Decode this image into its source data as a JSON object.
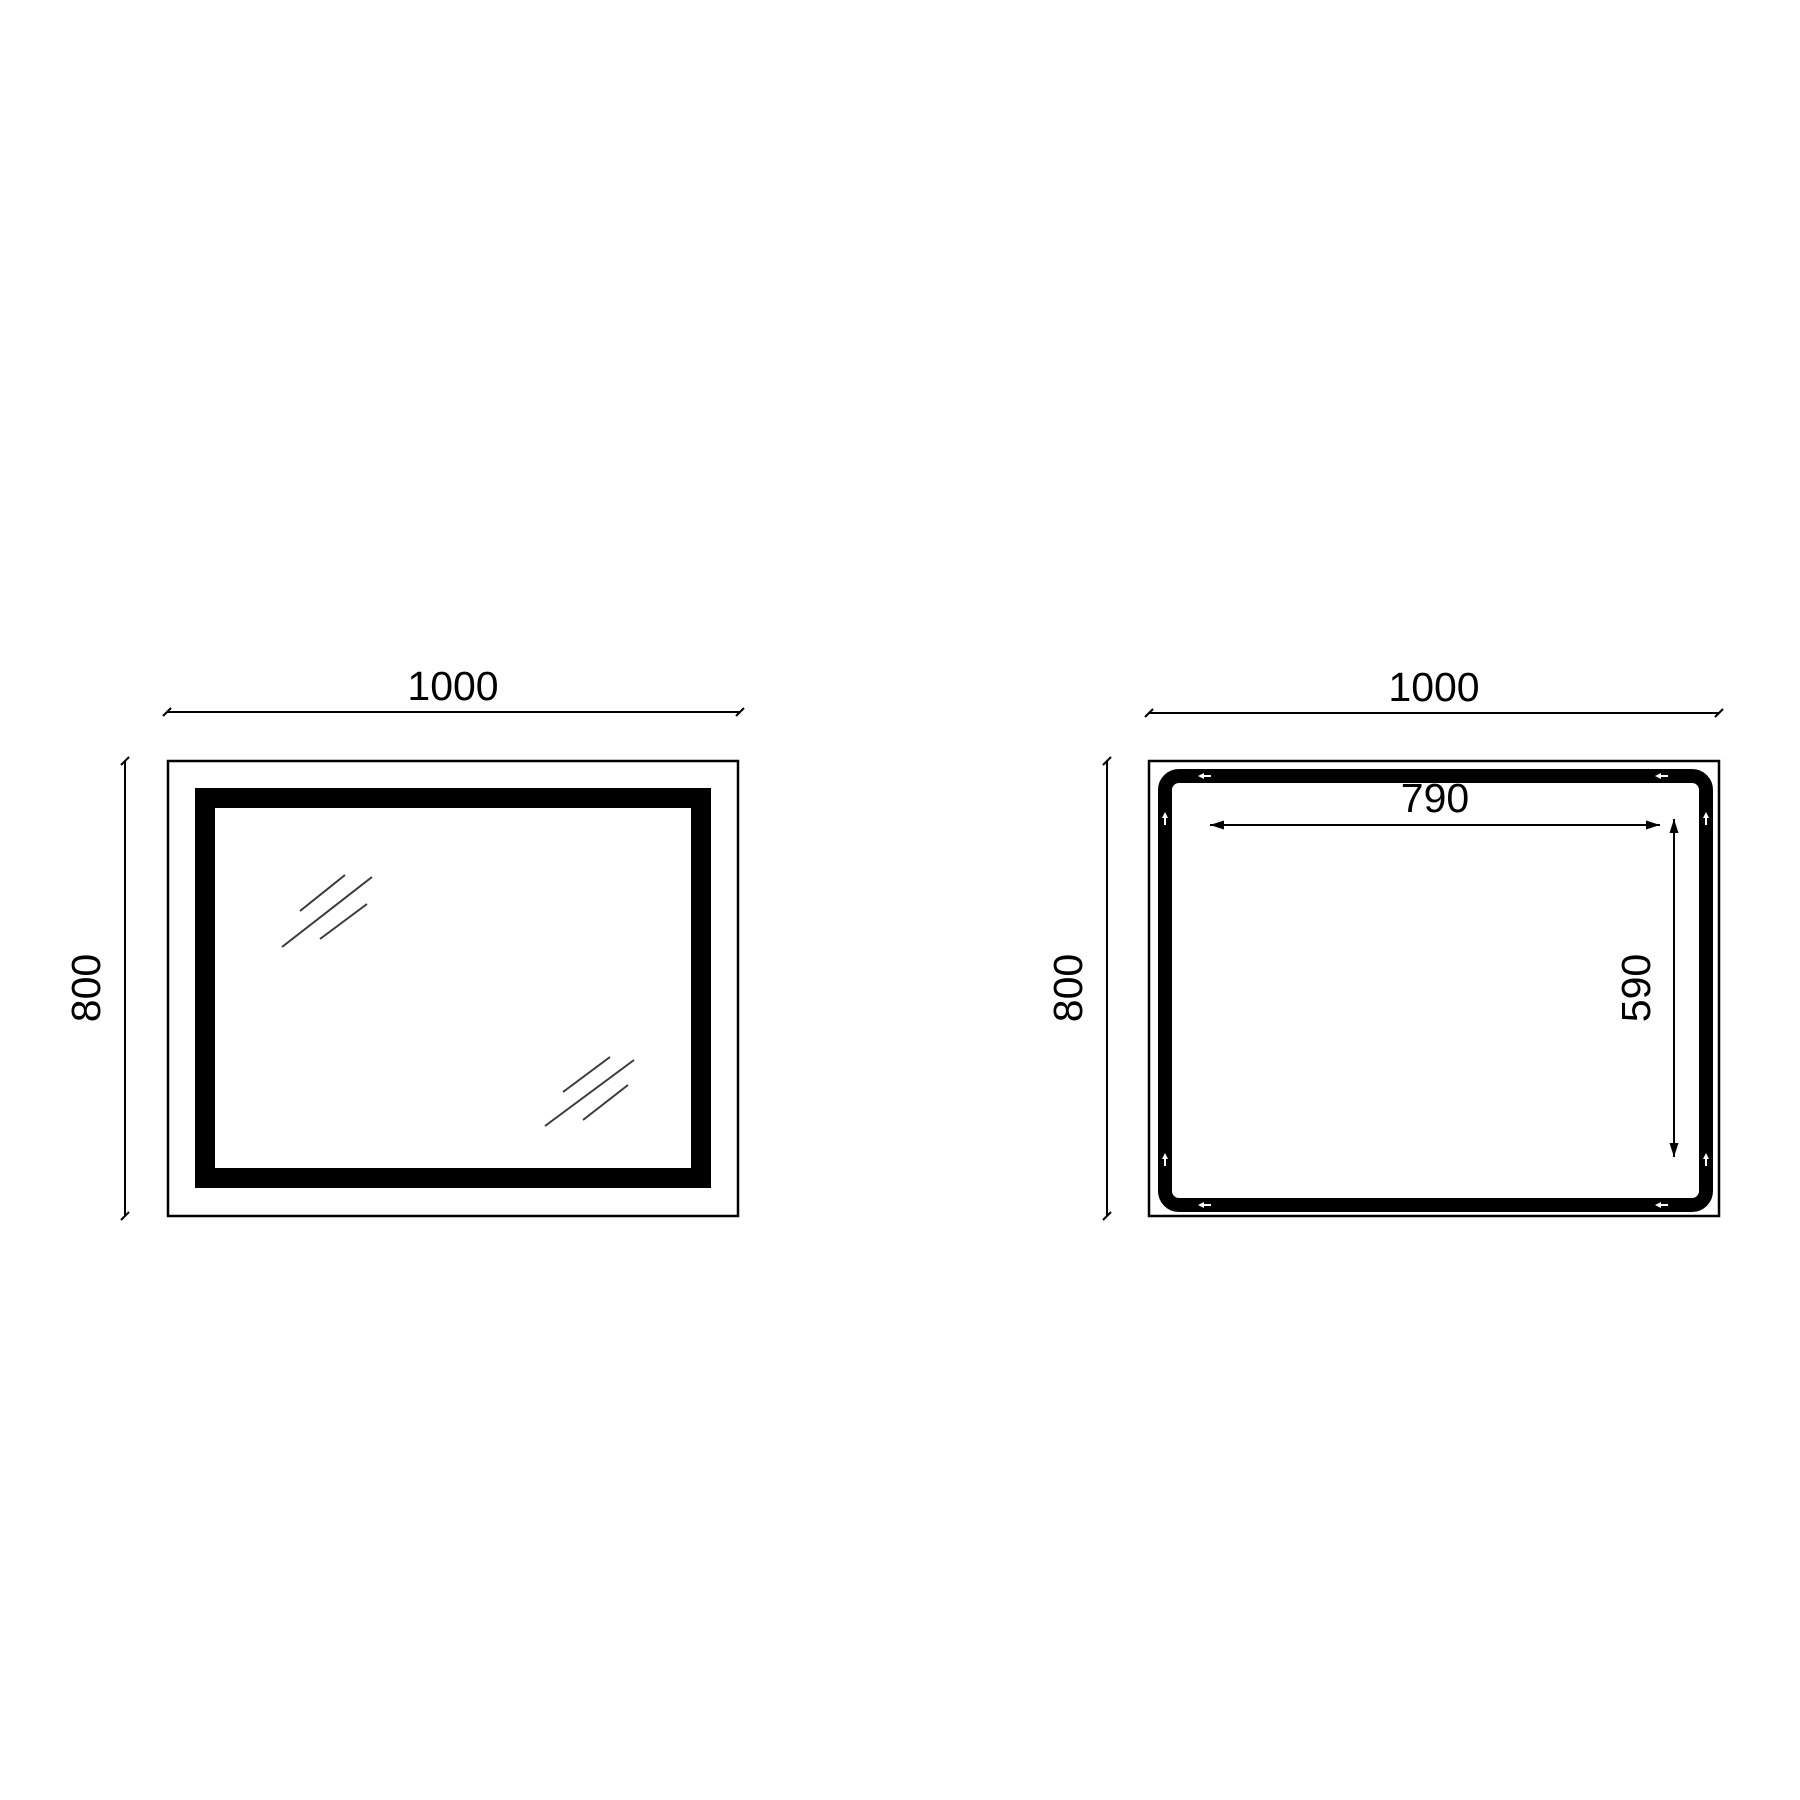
{
  "diagram": {
    "front_view": {
      "width": "1000",
      "height": "800"
    },
    "back_view": {
      "width": "1000",
      "height": "800",
      "inner_width": "790",
      "inner_height": "590"
    }
  }
}
